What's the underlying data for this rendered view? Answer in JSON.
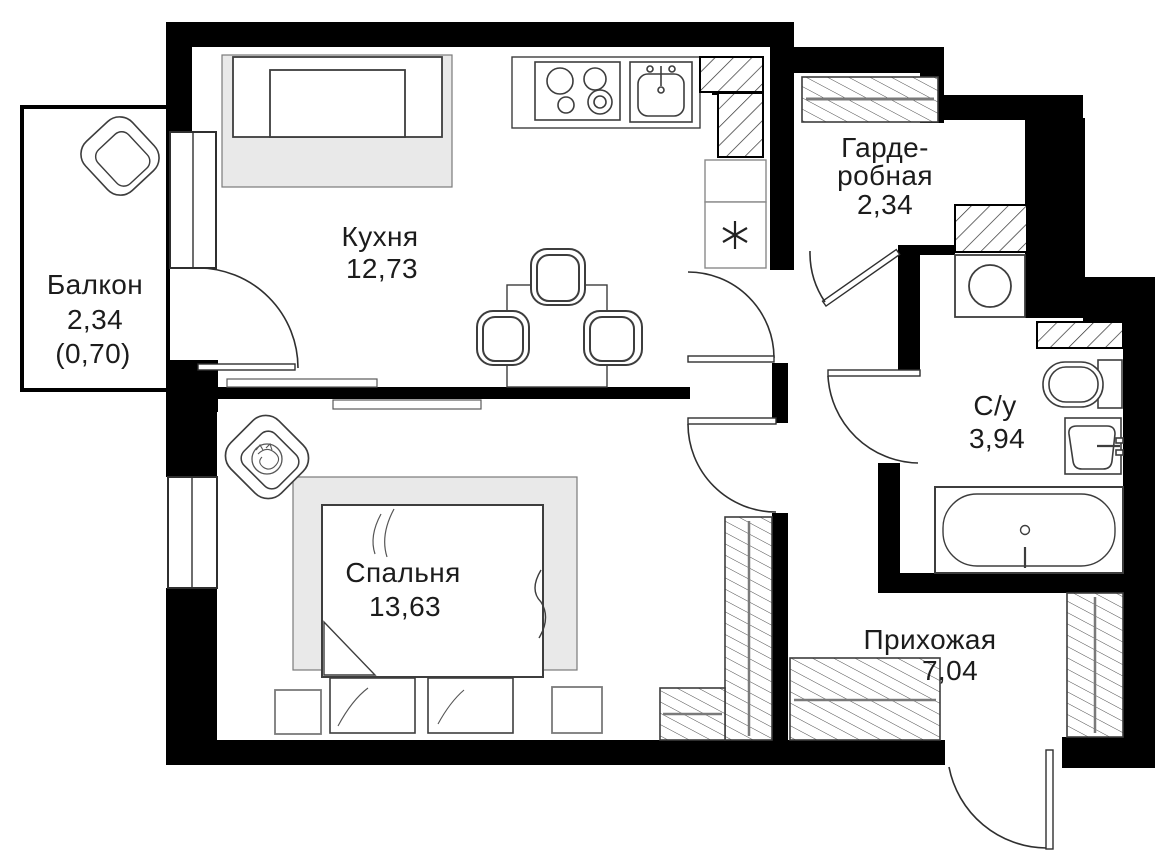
{
  "plan": {
    "type": "apartment-floor-plan",
    "canvas": {
      "width": 1155,
      "height": 861
    },
    "rooms": [
      {
        "id": "balcony",
        "name": "Балкон",
        "area": "2,34",
        "area_note": "(0,70)"
      },
      {
        "id": "kitchen",
        "name": "Кухня",
        "area": "12,73"
      },
      {
        "id": "wardrobe",
        "name_line1": "Гарде-",
        "name_line2": "робная",
        "area": "2,34"
      },
      {
        "id": "bathroom",
        "name": "С/у",
        "area": "3,94"
      },
      {
        "id": "bedroom",
        "name": "Спальня",
        "area": "13,63"
      },
      {
        "id": "hallway",
        "name": "Прихожая",
        "area": "7,04"
      }
    ],
    "fixtures": {
      "balcony": [
        "armchair-icon"
      ],
      "kitchen": [
        "sofa-icon",
        "counter-icon",
        "stove-icon",
        "kitchen-sink-icon",
        "fridge-icon",
        "dining-table-icon",
        "chair-icon",
        "vent-shaft-icon"
      ],
      "wardrobe": [
        "clothes-rail-icon"
      ],
      "bathroom": [
        "washing-machine-icon",
        "toilet-icon",
        "washbasin-icon",
        "bathtub-icon",
        "vent-shaft-icon"
      ],
      "bedroom": [
        "bed-icon",
        "rug-icon",
        "nightstand-icon",
        "bench-icon",
        "armchair-with-cat-icon",
        "closet-icon"
      ],
      "hallway": [
        "closet-icon",
        "entrance-door-icon"
      ]
    },
    "colors": {
      "wall": "#000000",
      "line": "#3d3d3d",
      "door_line": "#2f2f2f",
      "rug": "#e9e9e9",
      "rail": "#7a7a7a",
      "paper": "#ffffff",
      "text": "#1c1c1c"
    }
  }
}
